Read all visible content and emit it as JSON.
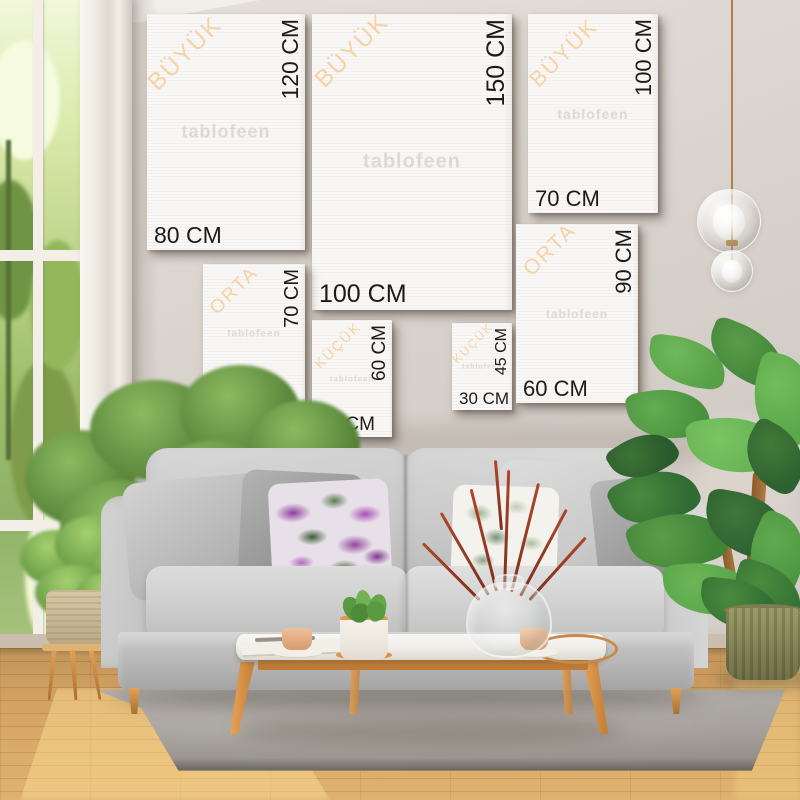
{
  "watermark": "tablofeen",
  "size_categories": {
    "large": "BÜYÜK",
    "medium": "ORTA",
    "small": "KÜÇÜK"
  },
  "canvases": [
    {
      "id": "canvas-80x120",
      "category_label": "BÜYÜK",
      "width_label": "80 CM",
      "height_label": "120 CM"
    },
    {
      "id": "canvas-100x150",
      "category_label": "BÜYÜK",
      "width_label": "100 CM",
      "height_label": "150 CM"
    },
    {
      "id": "canvas-70x100",
      "category_label": "BÜYÜK",
      "width_label": "70 CM",
      "height_label": "100 CM"
    },
    {
      "id": "canvas-50x70",
      "category_label": "ORTA",
      "width_label": "50 CM",
      "height_label": "70 CM"
    },
    {
      "id": "canvas-40x60",
      "category_label": "KÜÇÜK",
      "width_label": "40 CM",
      "height_label": "60 CM"
    },
    {
      "id": "canvas-30x45",
      "category_label": "KÜÇÜK",
      "width_label": "30 CM",
      "height_label": "45 CM"
    },
    {
      "id": "canvas-60x90",
      "category_label": "ORTA",
      "width_label": "60 CM",
      "height_label": "90 CM"
    }
  ],
  "colors": {
    "category_label_accent": "#f6d2a4",
    "dimension_text": "#1b1b1b",
    "canvas_white": "#f9f8f6",
    "wall_greige": "#d7d0ca",
    "sofa_gray": "#c9cac9",
    "wood_accent": "#dd9a4c",
    "rug_gray": "#a29e99",
    "floor_oak": "#d8a763",
    "plant_green": "#4e8a3c",
    "pillow_purple": "#8c3d9b"
  }
}
